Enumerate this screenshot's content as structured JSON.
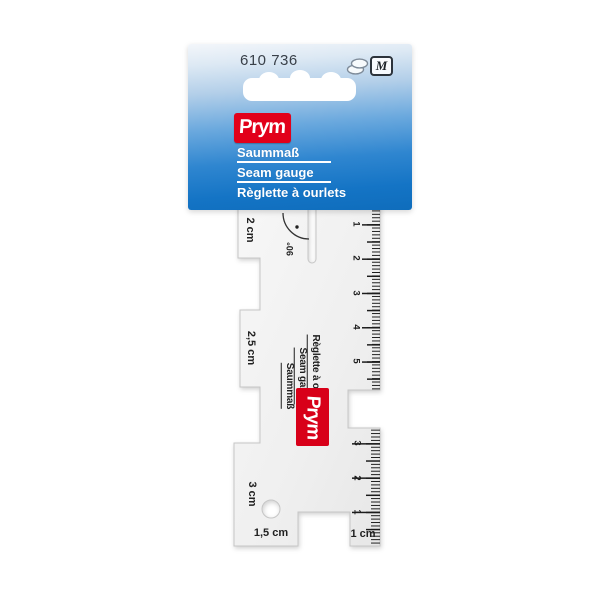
{
  "card": {
    "product_number": "610 736",
    "size_badge": "M",
    "brand": "Prym",
    "title_de": "Saummaß",
    "title_en": "Seam gauge",
    "title_fr": "Règlette à ourlets",
    "colors": {
      "blue_bottom": "#0f6dbc",
      "prym_red": "#e2001a"
    }
  },
  "ruler": {
    "angle_label": "90°",
    "brand": "Prym",
    "label_de": "Saummaß",
    "label_en": "Seam gauge",
    "label_fr": "Règlette à ourlet",
    "steps": {
      "top": "2 cm",
      "middle": "2,5 cm",
      "bottom": "3 cm",
      "bottom_edge": "1,5 cm",
      "right_tab": "1 cm"
    },
    "upper_scale": {
      "numbers": [
        "1",
        "2",
        "3",
        "4",
        "5"
      ]
    },
    "lower_scale": {
      "numbers": [
        "3",
        "2",
        "1"
      ]
    }
  }
}
